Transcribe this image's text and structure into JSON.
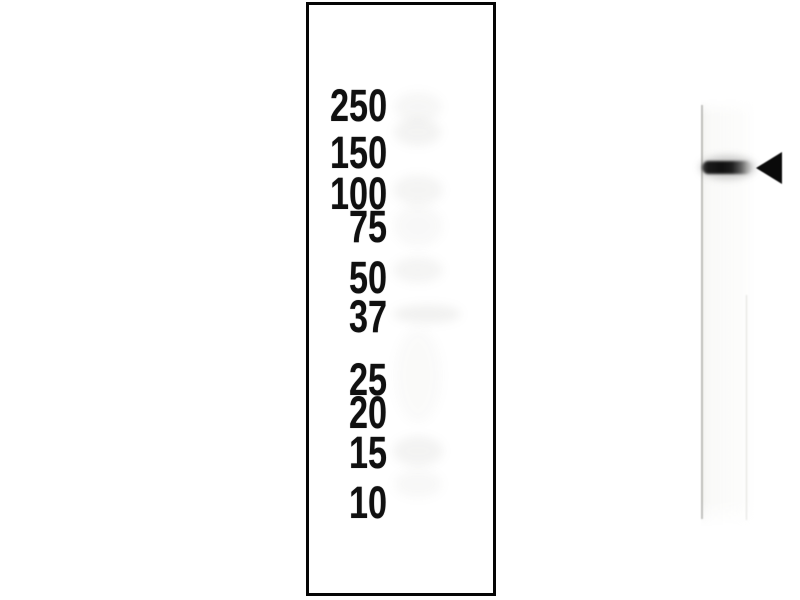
{
  "blot": {
    "kind": "western-blot-figure",
    "ladder_labels": [
      "250",
      "150",
      "100",
      "75",
      "50",
      "37",
      "25",
      "20",
      "15",
      "10"
    ],
    "markers": [
      {
        "label": "250",
        "y": 108
      },
      {
        "label": "150",
        "y": 155
      },
      {
        "label": "100",
        "y": 196
      },
      {
        "label": "75",
        "y": 229
      },
      {
        "label": "50",
        "y": 280
      },
      {
        "label": "37",
        "y": 319
      },
      {
        "label": "25",
        "y": 382
      },
      {
        "label": "20",
        "y": 415
      },
      {
        "label": "15",
        "y": 455
      },
      {
        "label": "10",
        "y": 505
      }
    ],
    "main_band": {
      "near_label": "150",
      "y": 163,
      "x_start": 393,
      "x_end": 443
    },
    "background_bands": [
      {
        "x": 394,
        "y": 92,
        "w": 48,
        "h": 30,
        "o": 0.07
      },
      {
        "x": 394,
        "y": 118,
        "w": 47,
        "h": 28,
        "o": 0.1
      },
      {
        "x": 393,
        "y": 175,
        "w": 50,
        "h": 30,
        "o": 0.09
      },
      {
        "x": 393,
        "y": 205,
        "w": 50,
        "h": 42,
        "o": 0.05
      },
      {
        "x": 393,
        "y": 257,
        "w": 50,
        "h": 26,
        "o": 0.09
      },
      {
        "x": 393,
        "y": 305,
        "w": 68,
        "h": 18,
        "o": 0.12
      },
      {
        "x": 394,
        "y": 328,
        "w": 48,
        "h": 95,
        "o": 0.04
      },
      {
        "x": 393,
        "y": 436,
        "w": 50,
        "h": 30,
        "o": 0.1
      },
      {
        "x": 394,
        "y": 470,
        "w": 48,
        "h": 28,
        "o": 0.06
      }
    ],
    "arrow": {
      "direction": "left",
      "tip_x": 447,
      "y": 163
    },
    "colors": {
      "panel_border": "#050505",
      "label_text": "#101010",
      "band_dark": "#101010",
      "lane_tint": "#efefec",
      "background": "#ffffff"
    }
  }
}
